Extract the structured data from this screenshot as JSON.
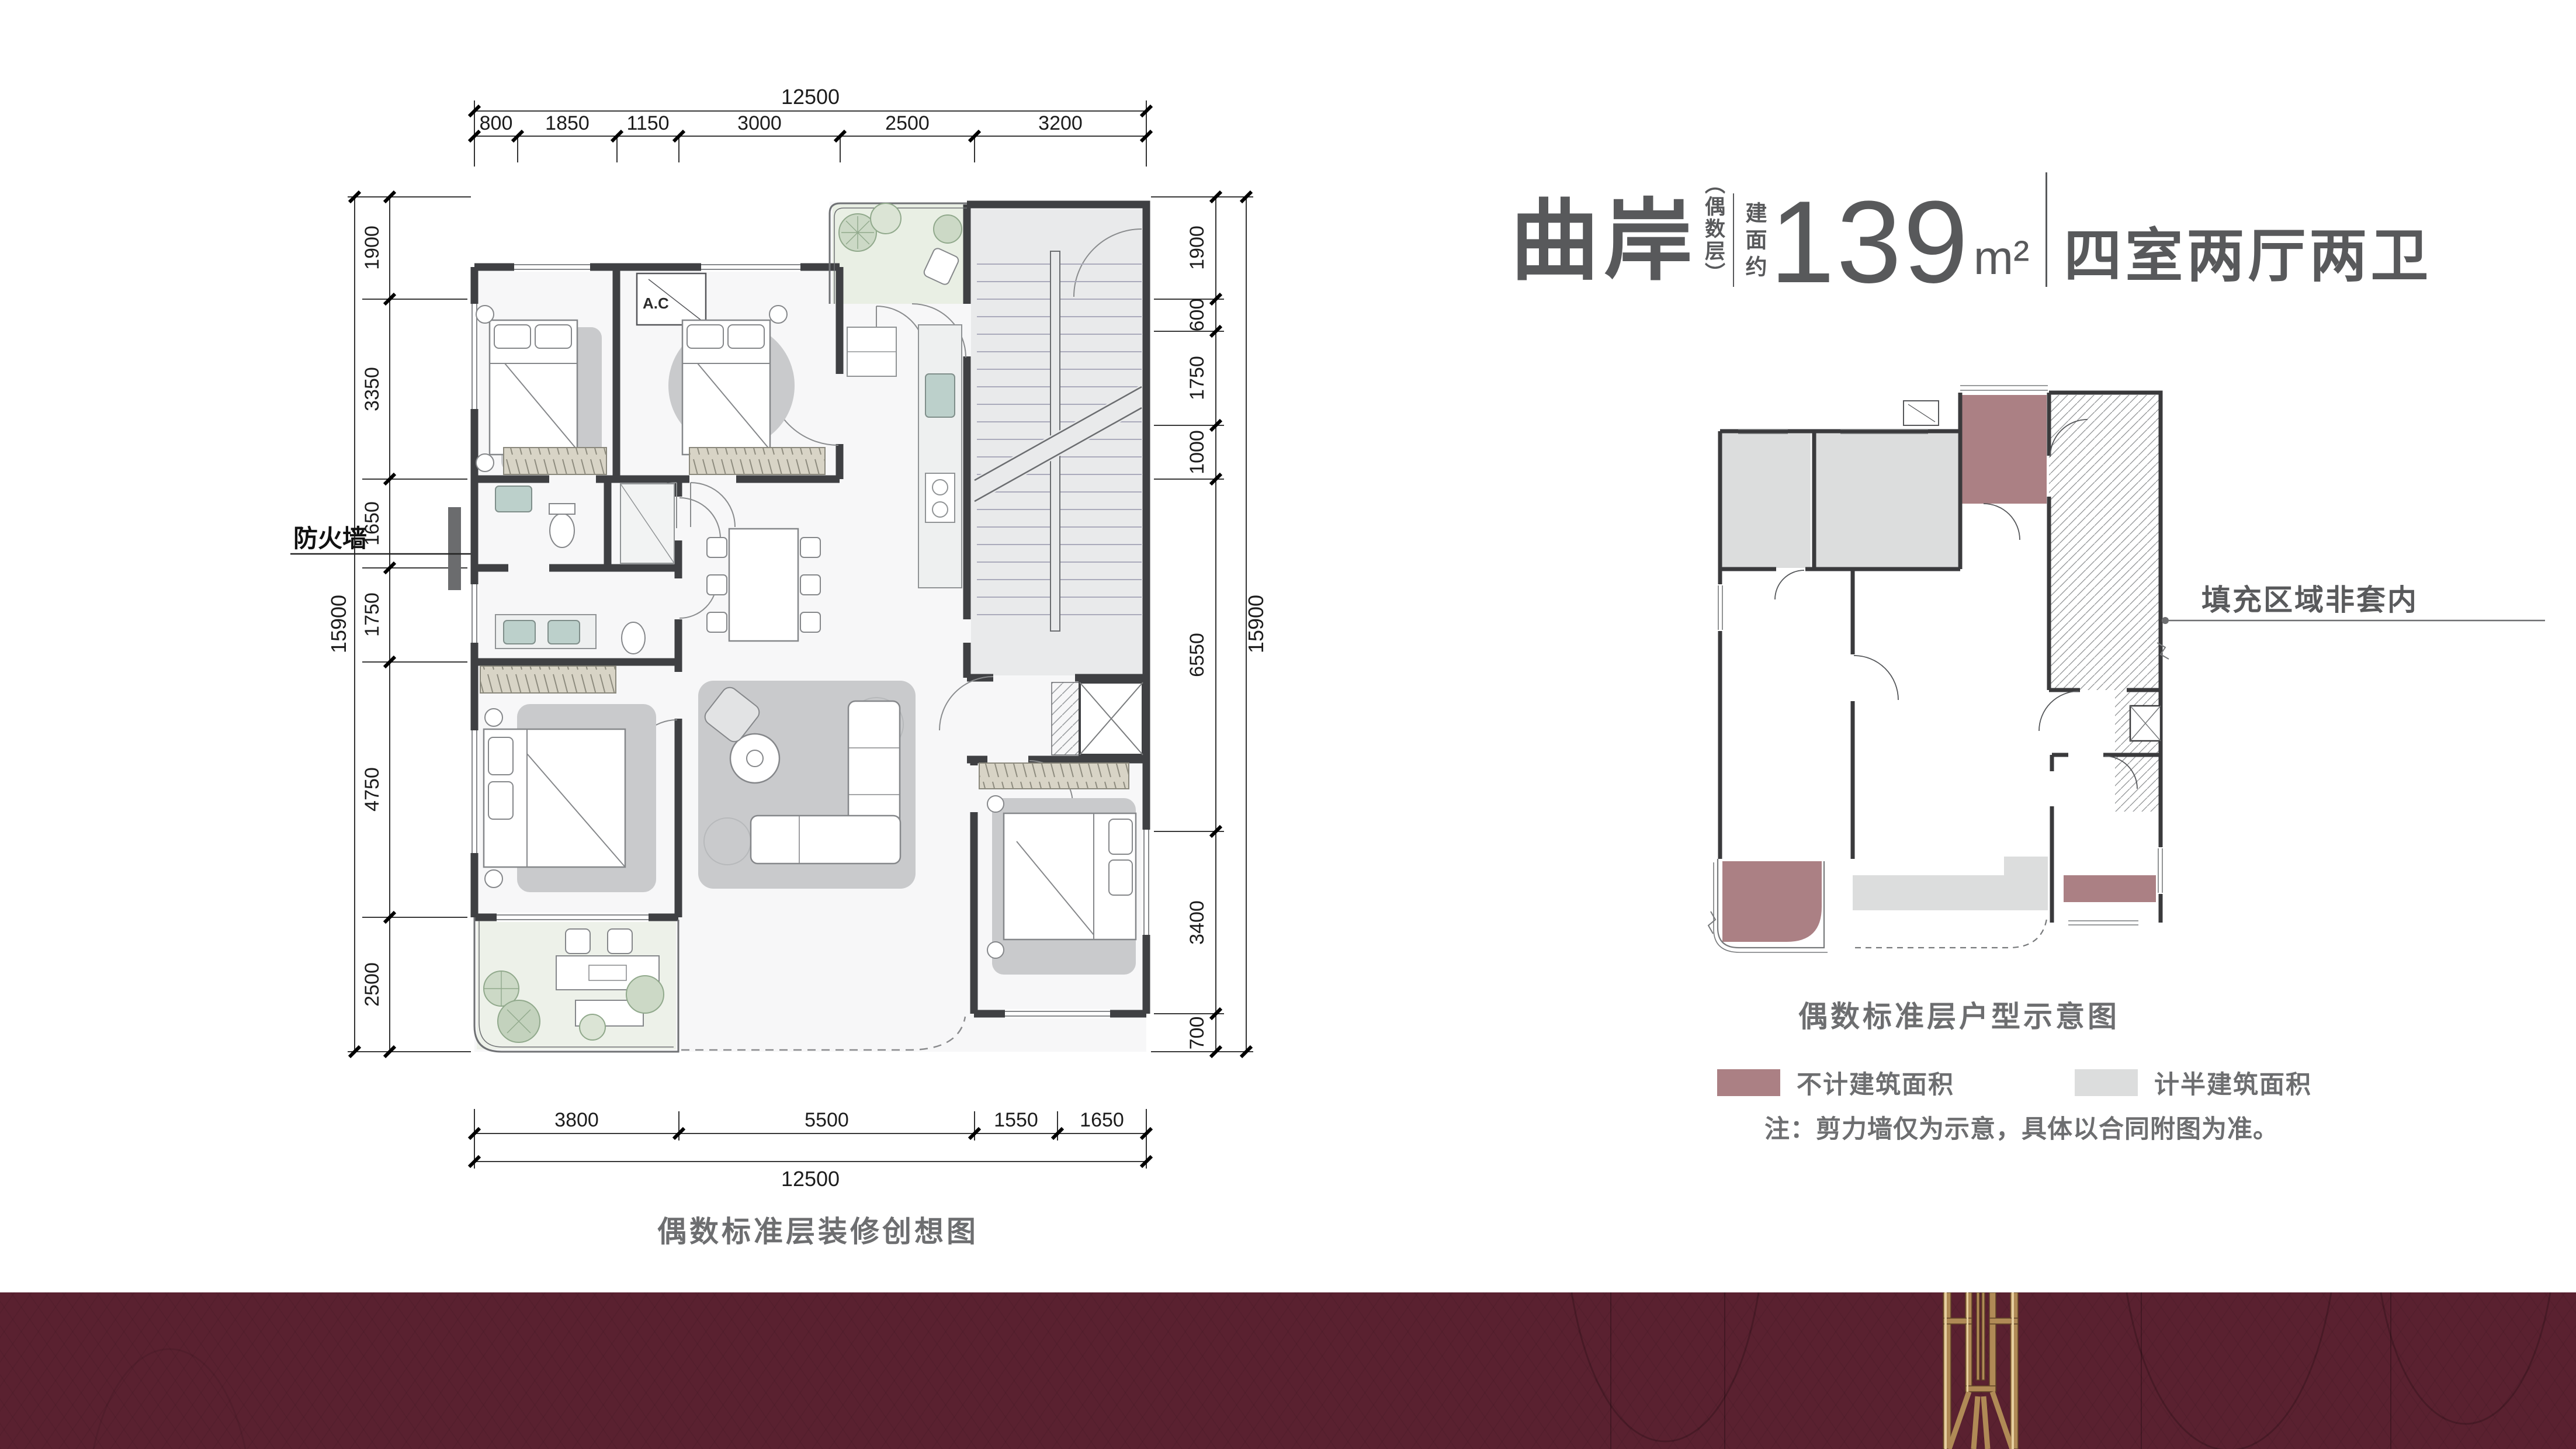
{
  "page": {
    "background": "#ffffff",
    "banner_color": "#5a2130",
    "text_gray": "#58595b"
  },
  "title_block": {
    "name": "曲岸",
    "floor_tag": "（偶数层）",
    "area_prefix": "建面约",
    "area_value": "139",
    "area_unit": "m²",
    "rooms": "四室两厅两卫"
  },
  "main_plan": {
    "caption": "偶数标准层装修创想图",
    "firewall_label": "防火墙",
    "ac_label": "A.C",
    "dims": {
      "top_total": "12500",
      "top_segments": [
        "800",
        "1850",
        "1150",
        "3000",
        "2500",
        "3200"
      ],
      "bottom_segments": [
        "3800",
        "5500",
        "1550",
        "1650"
      ],
      "bottom_total": "12500",
      "left_total": "15900",
      "left_segments": [
        "1900",
        "3350",
        "1650",
        "1750",
        "4750",
        "2500"
      ],
      "right_total": "15900",
      "right_segments": [
        "1900",
        "600",
        "1750",
        "1000",
        "6550",
        "3400",
        "700"
      ]
    }
  },
  "schematic_plan": {
    "caption": "偶数标准层户型示意图",
    "callout_label": "填充区域非套内"
  },
  "legend": {
    "items": [
      {
        "label": "不计建筑面积",
        "color": "#ab8084"
      },
      {
        "label": "计半建筑面积",
        "color": "#dcdddd"
      }
    ]
  },
  "note": "注：剪力墙仅为示意，具体以合同附图为准。"
}
